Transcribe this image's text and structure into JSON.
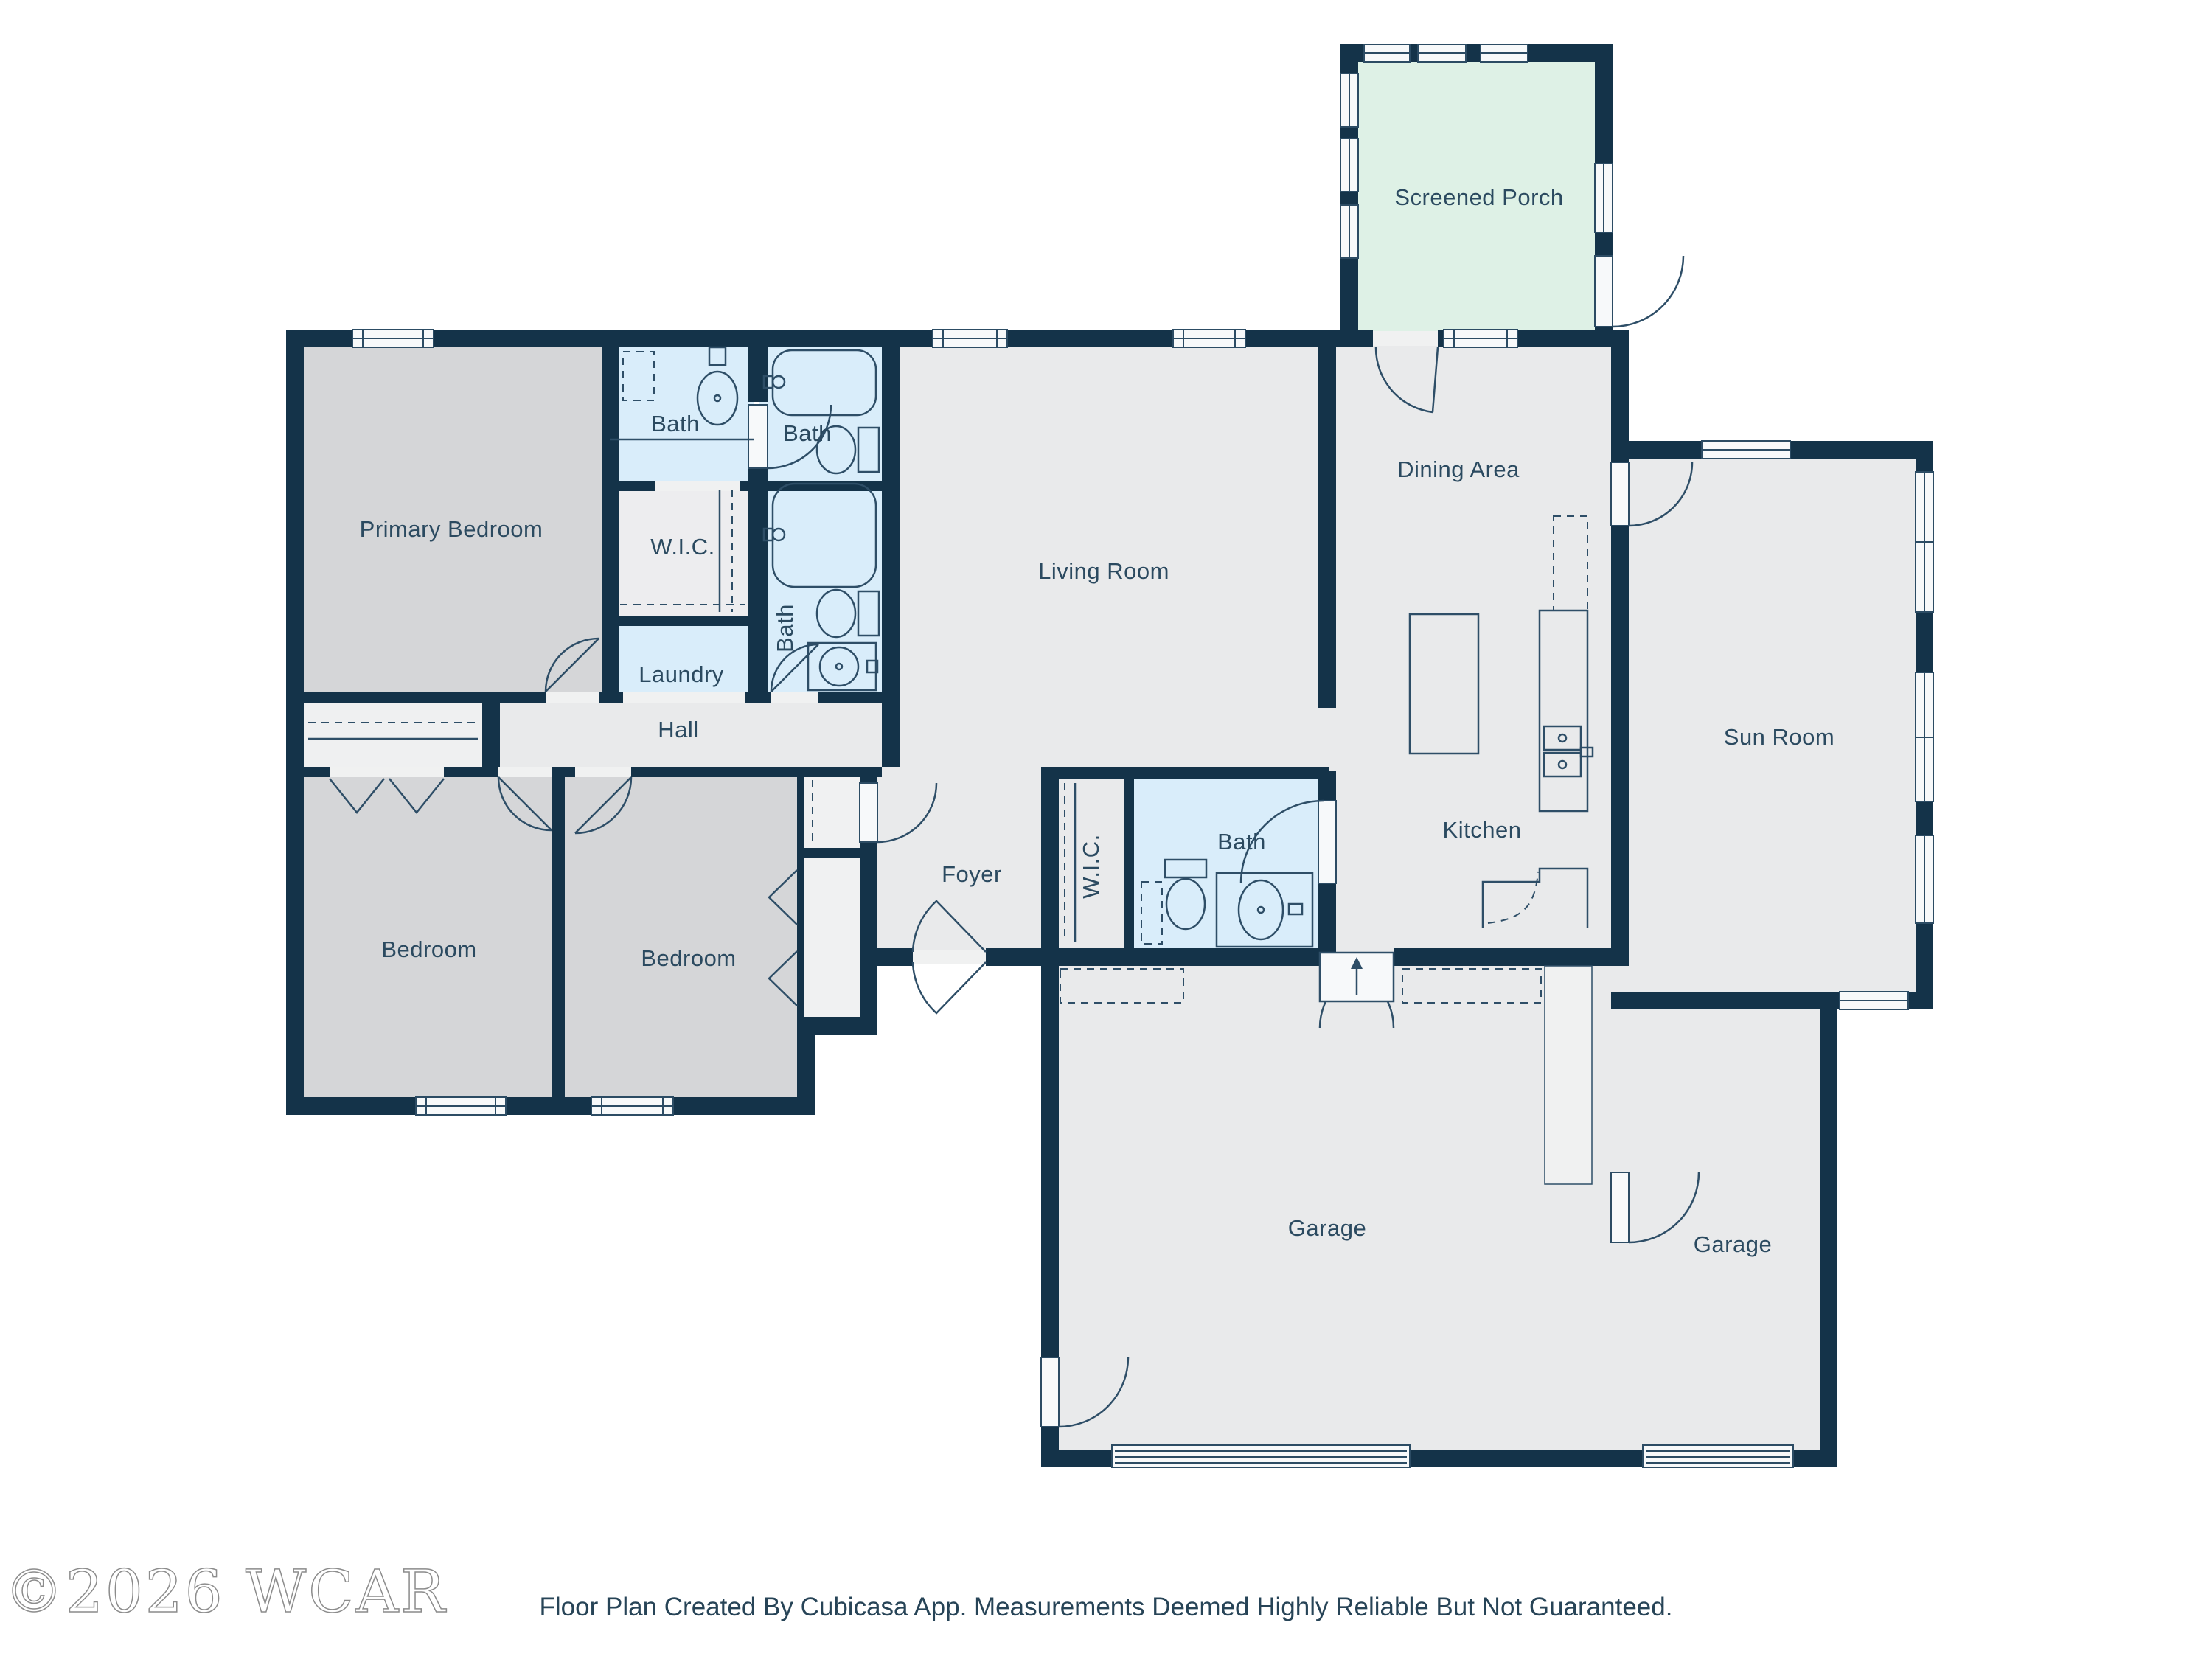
{
  "plan": {
    "rooms": [
      {
        "id": "screened-porch",
        "label": "Screened Porch"
      },
      {
        "id": "primary-bedroom",
        "label": "Primary Bedroom"
      },
      {
        "id": "bath-1",
        "label": "Bath"
      },
      {
        "id": "bath-2",
        "label": "Bath"
      },
      {
        "id": "wic-1",
        "label": "W.I.C."
      },
      {
        "id": "bath-3",
        "label": "Bath"
      },
      {
        "id": "laundry",
        "label": "Laundry"
      },
      {
        "id": "hall",
        "label": "Hall"
      },
      {
        "id": "living-room",
        "label": "Living Room"
      },
      {
        "id": "dining-area",
        "label": "Dining Area"
      },
      {
        "id": "kitchen",
        "label": "Kitchen"
      },
      {
        "id": "sun-room",
        "label": "Sun Room"
      },
      {
        "id": "foyer",
        "label": "Foyer"
      },
      {
        "id": "wic-2",
        "label": "W.I.C."
      },
      {
        "id": "bath-4",
        "label": "Bath"
      },
      {
        "id": "bedroom-1",
        "label": "Bedroom"
      },
      {
        "id": "bedroom-2",
        "label": "Bedroom"
      },
      {
        "id": "garage-1",
        "label": "Garage"
      },
      {
        "id": "garage-2",
        "label": "Garage"
      }
    ],
    "colors": {
      "wall": "#143349",
      "floor": "#e9eaeb",
      "bedroom": "#d5d6d8",
      "bath": "#d9edfa",
      "closet": "#f0f1f2",
      "wic": "#ededef",
      "porch": "#def1e6",
      "label": "#2b4a60"
    }
  },
  "footer": {
    "watermark": "©2026 WCAR",
    "caption": "Floor Plan Created By Cubicasa App. Measurements Deemed Highly Reliable But Not Guaranteed."
  }
}
